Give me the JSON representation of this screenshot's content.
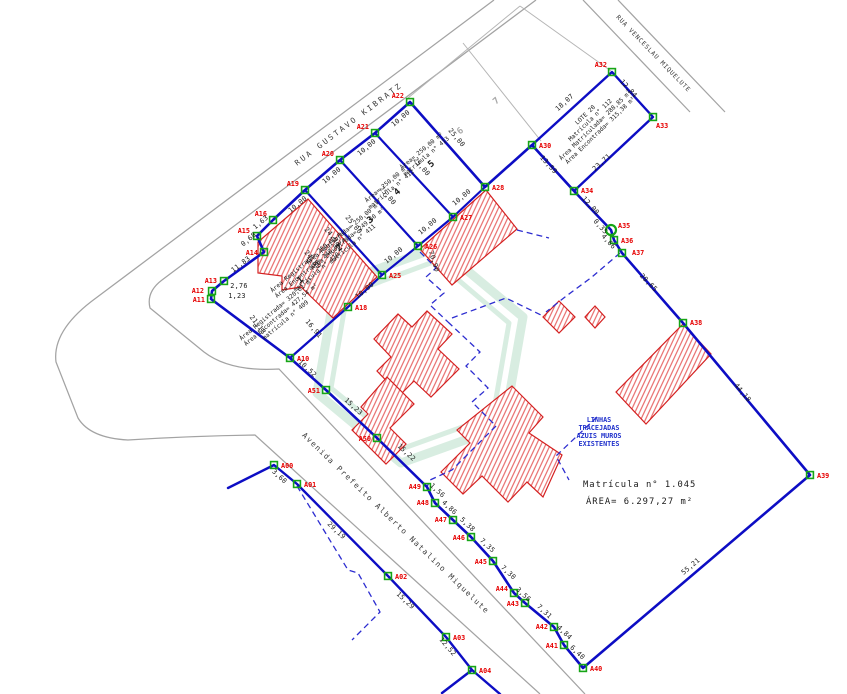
{
  "colors": {
    "boundary_blue": "#0d0dc4",
    "wall_dashed_blue": "#2d2dd0",
    "marker_green": "#16a516",
    "vertex_label_red": "#e60000",
    "building_outline_red": "#d42020",
    "hatch_red": "#e66060",
    "street_gray": "#a3a3a3",
    "cad_black": "#1a1a1a",
    "note_blue": "#2233cc",
    "watermark_green": "#cfe9da"
  },
  "streets": {
    "names": [
      {
        "name": "RUA GUSTAVO KIBRATZ",
        "x": 350,
        "y": 126,
        "rot": -37,
        "size": 7.6,
        "spacing": 2.4
      },
      {
        "name": "RUA VENCESLAU MIQUELUTE",
        "x": 652,
        "y": 55,
        "rot": 46,
        "size": 6.2,
        "spacing": 0.8
      },
      {
        "name": "Avenida Prefeito Alberto Natalino Miquelute",
        "x": 394,
        "y": 525,
        "rot": 44,
        "size": 7.6,
        "spacing": 1.4
      }
    ],
    "paths": [
      "M494,0 L96,298 Q52,330 56,362 L78,418 Q90,438 128,440 Q190,436 255,435 L540,694",
      "M536,0 L162,280 Q146,292 150,308 L204,352 Q230,372 279,369 L585,694",
      "M583,0 L690,112",
      "M618,0 L725,112"
    ]
  },
  "gray_lots": {
    "lines": [
      "M408,98 L520,6",
      "M520,6 L611,71",
      "M463,43 L541,141"
    ],
    "numbers": [
      {
        "t": "6",
        "x": 462,
        "y": 133
      },
      {
        "t": "7",
        "x": 498,
        "y": 103
      }
    ]
  },
  "watermark": {
    "outer": "523,317 439,247 336,284 317,393 401,463 504,426",
    "inner": "509,323 436,261 347,294 331,388 404,448 493,416"
  },
  "buildings": [
    {
      "pts": "308,199 377,277 333,318 301,287 282,290 282,276 258,273 258,242"
    },
    {
      "pts": "486,190 517,229 452,285 420,249"
    },
    {
      "pts": "427,311 452,334 438,349 459,369 431,397 414,381 400,395 377,371 391,357 374,339 398,314 412,327"
    },
    {
      "pts": "387,377 414,404 390,428 406,444 386,464 352,430 368,414 361,407"
    },
    {
      "pts": "512,386 543,417 529,433 562,455 543,497 527,482 508,502 482,476 463,494 441,472 470,443 457,430"
    },
    {
      "pts": "683,324 711,354 646,424 616,392"
    },
    {
      "pts": "559,301 575,317 559,333 543,317"
    },
    {
      "pts": "595,306 605,317 595,328 585,317"
    }
  ],
  "dashed_walls": [
    "297,486 348,570 358,573 380,612 352,640",
    "420,252 436,268 426,277 444,293 430,305 448,322",
    "448,322 480,352 466,366 488,388 472,402 496,426 452,470 430,480 427,487",
    "452,318 506,298 541,315",
    "620,253 592,277 565,297 546,312",
    "597,417 556,456 569,480",
    "517,230 549,238"
  ],
  "boundaries": [
    {
      "w": 2.6,
      "pts": "290,358 211,299 212,291 224,281 264,252 257,236 273,220 305,190 340,160 375,133 410,102 485,187 532,145 574,191 611,230 614,240 622,253 683,323 810,475 583,668 564,645 554,627 525,603 514,593 493,561 471,537 453,520 435,503 427,487 377,438 326,390 290,358"
    },
    {
      "w": 2.2,
      "pts": "382,275 418,246 453,217 485,187"
    },
    {
      "w": 2.2,
      "pts": "305,190 382,275"
    },
    {
      "w": 2.2,
      "pts": "340,160 418,246"
    },
    {
      "w": 2.2,
      "pts": "375,133 453,217"
    },
    {
      "w": 2.2,
      "pts": "382,275 348,307 290,358"
    },
    {
      "w": 2.4,
      "pts": "532,145 612,72 653,117 574,191 532,145"
    },
    {
      "w": 2.4,
      "pts": "228,488 274,465 297,484 388,576 446,637 472,670 500,694"
    },
    {
      "w": 2.4,
      "pts": "472,670 442,693"
    }
  ],
  "vertices": [
    {
      "id": "A00",
      "x": 274,
      "y": 465,
      "lx": 281,
      "ly": 468,
      "a": "start",
      "m": "sq"
    },
    {
      "id": "A01",
      "x": 297,
      "y": 484,
      "lx": 304,
      "ly": 487,
      "a": "start",
      "m": "sq"
    },
    {
      "id": "A02",
      "x": 388,
      "y": 576,
      "lx": 395,
      "ly": 579,
      "a": "start",
      "m": "sq"
    },
    {
      "id": "A03",
      "x": 446,
      "y": 637,
      "lx": 453,
      "ly": 640,
      "a": "start",
      "m": "sq"
    },
    {
      "id": "A04",
      "x": 472,
      "y": 670,
      "lx": 479,
      "ly": 673,
      "a": "start",
      "m": "sq"
    },
    {
      "id": "A10",
      "x": 290,
      "y": 358,
      "lx": 297,
      "ly": 361,
      "a": "start",
      "m": "sq"
    },
    {
      "id": "A11",
      "x": 211,
      "y": 299,
      "lx": 205,
      "ly": 302,
      "a": "end",
      "m": "sq"
    },
    {
      "id": "A12",
      "x": 212,
      "y": 291,
      "lx": 204,
      "ly": 293,
      "a": "end",
      "m": "sq"
    },
    {
      "id": "A13",
      "x": 224,
      "y": 281,
      "lx": 217,
      "ly": 283,
      "a": "end",
      "m": "sq"
    },
    {
      "id": "A14",
      "x": 264,
      "y": 252,
      "lx": 258,
      "ly": 255,
      "a": "end",
      "m": "sq"
    },
    {
      "id": "A15",
      "x": 257,
      "y": 236,
      "lx": 250,
      "ly": 233,
      "a": "end",
      "m": "sq"
    },
    {
      "id": "A16",
      "x": 273,
      "y": 220,
      "lx": 267,
      "ly": 216,
      "a": "end",
      "m": "sq"
    },
    {
      "id": "A18",
      "x": 348,
      "y": 307,
      "lx": 355,
      "ly": 310,
      "a": "start",
      "m": "sq"
    },
    {
      "id": "A19",
      "x": 305,
      "y": 190,
      "lx": 299,
      "ly": 186,
      "a": "end",
      "m": "sq"
    },
    {
      "id": "A20",
      "x": 340,
      "y": 160,
      "lx": 334,
      "ly": 156,
      "a": "end",
      "m": "sq"
    },
    {
      "id": "A21",
      "x": 375,
      "y": 133,
      "lx": 369,
      "ly": 129,
      "a": "end",
      "m": "sq"
    },
    {
      "id": "A22",
      "x": 410,
      "y": 102,
      "lx": 404,
      "ly": 98,
      "a": "end",
      "m": "sq"
    },
    {
      "id": "A25",
      "x": 382,
      "y": 275,
      "lx": 389,
      "ly": 278,
      "a": "start",
      "m": "sq"
    },
    {
      "id": "A26",
      "x": 418,
      "y": 246,
      "lx": 425,
      "ly": 249,
      "a": "start",
      "m": "sq"
    },
    {
      "id": "A27",
      "x": 453,
      "y": 217,
      "lx": 460,
      "ly": 220,
      "a": "start",
      "m": "sq"
    },
    {
      "id": "A28",
      "x": 485,
      "y": 187,
      "lx": 492,
      "ly": 190,
      "a": "start",
      "m": "sq"
    },
    {
      "id": "A30",
      "x": 532,
      "y": 145,
      "lx": 539,
      "ly": 148,
      "a": "start",
      "m": "sq"
    },
    {
      "id": "A32",
      "x": 612,
      "y": 72,
      "lx": 607,
      "ly": 67,
      "a": "end",
      "m": "sq"
    },
    {
      "id": "A33",
      "x": 653,
      "y": 117,
      "lx": 656,
      "ly": 128,
      "a": "start",
      "m": "sq"
    },
    {
      "id": "A34",
      "x": 574,
      "y": 191,
      "lx": 581,
      "ly": 193,
      "a": "start",
      "m": "sq"
    },
    {
      "id": "A35",
      "x": 611,
      "y": 230,
      "lx": 618,
      "ly": 228,
      "a": "start",
      "m": "ci"
    },
    {
      "id": "A36",
      "x": 614,
      "y": 240,
      "lx": 621,
      "ly": 243,
      "a": "start",
      "m": "sq"
    },
    {
      "id": "A37",
      "x": 622,
      "y": 253,
      "lx": 632,
      "ly": 255,
      "a": "start",
      "m": "sq"
    },
    {
      "id": "A38",
      "x": 683,
      "y": 323,
      "lx": 690,
      "ly": 325,
      "a": "start",
      "m": "sq"
    },
    {
      "id": "A39",
      "x": 810,
      "y": 475,
      "lx": 817,
      "ly": 478,
      "a": "start",
      "m": "sq"
    },
    {
      "id": "A40",
      "x": 583,
      "y": 668,
      "lx": 590,
      "ly": 671,
      "a": "start",
      "m": "sq"
    },
    {
      "id": "A41",
      "x": 564,
      "y": 645,
      "lx": 558,
      "ly": 648,
      "a": "end",
      "m": "sq"
    },
    {
      "id": "A42",
      "x": 554,
      "y": 627,
      "lx": 548,
      "ly": 629,
      "a": "end",
      "m": "sq"
    },
    {
      "id": "A43",
      "x": 525,
      "y": 603,
      "lx": 519,
      "ly": 606,
      "a": "end",
      "m": "sq"
    },
    {
      "id": "A44",
      "x": 514,
      "y": 593,
      "lx": 508,
      "ly": 591,
      "a": "end",
      "m": "sq"
    },
    {
      "id": "A45",
      "x": 493,
      "y": 561,
      "lx": 487,
      "ly": 564,
      "a": "end",
      "m": "sq"
    },
    {
      "id": "A46",
      "x": 471,
      "y": 537,
      "lx": 465,
      "ly": 540,
      "a": "end",
      "m": "sq"
    },
    {
      "id": "A47",
      "x": 453,
      "y": 520,
      "lx": 447,
      "ly": 522,
      "a": "end",
      "m": "sq"
    },
    {
      "id": "A48",
      "x": 435,
      "y": 503,
      "lx": 429,
      "ly": 505,
      "a": "end",
      "m": "sq"
    },
    {
      "id": "A49",
      "x": 427,
      "y": 487,
      "lx": 421,
      "ly": 489,
      "a": "end",
      "m": "sq"
    },
    {
      "id": "A50",
      "x": 377,
      "y": 438,
      "lx": 371,
      "ly": 441,
      "a": "end",
      "m": "sq"
    },
    {
      "id": "A51",
      "x": 326,
      "y": 390,
      "lx": 320,
      "ly": 393,
      "a": "end",
      "m": "sq"
    }
  ],
  "measurements": [
    {
      "t": "10,00",
      "x": 299,
      "y": 206,
      "r": -40
    },
    {
      "t": "10,00",
      "x": 333,
      "y": 177,
      "r": -40
    },
    {
      "t": "10,00",
      "x": 368,
      "y": 149,
      "r": -40
    },
    {
      "t": "10,00",
      "x": 402,
      "y": 120,
      "r": -40
    },
    {
      "t": "10,00",
      "x": 395,
      "y": 257,
      "r": -40
    },
    {
      "t": "10,00",
      "x": 429,
      "y": 228,
      "r": -40
    },
    {
      "t": "10,00",
      "x": 463,
      "y": 199,
      "r": -40
    },
    {
      "t": "10,00",
      "x": 366,
      "y": 292,
      "r": -40
    },
    {
      "t": "25,00",
      "x": 352,
      "y": 226,
      "r": 50
    },
    {
      "t": "25,00",
      "x": 386,
      "y": 197,
      "r": 50
    },
    {
      "t": "25,00",
      "x": 420,
      "y": 168,
      "r": 50
    },
    {
      "t": "25,00",
      "x": 455,
      "y": 139,
      "r": 50
    },
    {
      "t": "70,90",
      "x": 432,
      "y": 262,
      "r": 72
    },
    {
      "t": "24,93",
      "x": 331,
      "y": 238,
      "r": 50
    },
    {
      "t": "24,89",
      "x": 311,
      "y": 261,
      "r": 50
    },
    {
      "t": "16,91",
      "x": 312,
      "y": 330,
      "r": 50
    },
    {
      "t": "21,18",
      "x": 256,
      "y": 326,
      "r": 52
    },
    {
      "t": "11,83",
      "x": 242,
      "y": 266,
      "r": -37
    },
    {
      "t": "2,76",
      "x": 239,
      "y": 288,
      "r": 0
    },
    {
      "t": "1,23",
      "x": 237,
      "y": 298,
      "r": 0
    },
    {
      "t": "0,68",
      "x": 250,
      "y": 241,
      "r": -40
    },
    {
      "t": "1,63",
      "x": 262,
      "y": 224,
      "r": -40
    },
    {
      "t": "10,52",
      "x": 306,
      "y": 370,
      "r": 43
    },
    {
      "t": "15,23",
      "x": 352,
      "y": 408,
      "r": 43
    },
    {
      "t": "15,22",
      "x": 405,
      "y": 454,
      "r": 43
    },
    {
      "t": "3,60",
      "x": 278,
      "y": 478,
      "r": 43
    },
    {
      "t": "29,19",
      "x": 335,
      "y": 532,
      "r": 43
    },
    {
      "t": "15,29",
      "x": 404,
      "y": 602,
      "r": 43
    },
    {
      "t": "12,52",
      "x": 446,
      "y": 648,
      "r": 50
    },
    {
      "t": "1,56",
      "x": 436,
      "y": 492,
      "r": 43
    },
    {
      "t": "4,86",
      "x": 448,
      "y": 509,
      "r": 43
    },
    {
      "t": "5,38",
      "x": 466,
      "y": 526,
      "r": 43
    },
    {
      "t": "7,35",
      "x": 486,
      "y": 547,
      "r": 43
    },
    {
      "t": "7,30",
      "x": 507,
      "y": 574,
      "r": 43
    },
    {
      "t": "3,56",
      "x": 522,
      "y": 596,
      "r": 43
    },
    {
      "t": "7,31",
      "x": 543,
      "y": 613,
      "r": 43
    },
    {
      "t": "4,84",
      "x": 563,
      "y": 634,
      "r": 43
    },
    {
      "t": "6,40",
      "x": 576,
      "y": 654,
      "r": 43
    },
    {
      "t": "12,00",
      "x": 589,
      "y": 207,
      "r": 48
    },
    {
      "t": "0,35",
      "x": 599,
      "y": 228,
      "r": 48
    },
    {
      "t": "4,66",
      "x": 607,
      "y": 243,
      "r": 48
    },
    {
      "t": "20,65",
      "x": 647,
      "y": 284,
      "r": 46
    },
    {
      "t": "44,18",
      "x": 741,
      "y": 394,
      "r": 50
    },
    {
      "t": "55,21",
      "x": 692,
      "y": 568,
      "r": -40
    },
    {
      "t": "13,59",
      "x": 547,
      "y": 166,
      "r": 48
    },
    {
      "t": "18,07",
      "x": 566,
      "y": 104,
      "r": -42
    },
    {
      "t": "12,84",
      "x": 627,
      "y": 90,
      "r": 48
    },
    {
      "t": "23,71",
      "x": 603,
      "y": 164,
      "r": -42
    }
  ],
  "lot_texts": [
    {
      "lines": [
        "Área Registrada= 320,61 m²",
        "Área Encontrada= 427,54 m²",
        "matrícula n° 409"
      ],
      "x": 282,
      "y": 316,
      "rot": -40
    },
    {
      "lines": [
        "Área Registrada= 250,00 m²",
        "Área Encontrada= 248,08 m²",
        "matrícula n° 410"
      ],
      "x": 313,
      "y": 268,
      "rot": -40
    },
    {
      "lines": [
        "Área Registrada= 250,00 m²",
        "Área Encontrada= 249,60 m²",
        "matrícula n° 411"
      ],
      "x": 349,
      "y": 240,
      "rot": -40
    },
    {
      "lines": [
        "Área= 250,00 m²",
        "matrícula n° 412"
      ],
      "x": 390,
      "y": 188,
      "rot": -40
    },
    {
      "lines": [
        "Área= 250,00 m²",
        "matrícula n° 413"
      ],
      "x": 425,
      "y": 155,
      "rot": -40
    }
  ],
  "lot_numbers": [
    {
      "t": "1",
      "x": 302,
      "y": 282
    },
    {
      "t": "2",
      "x": 341,
      "y": 250
    },
    {
      "t": "3",
      "x": 372,
      "y": 222
    },
    {
      "t": "4",
      "x": 399,
      "y": 194
    },
    {
      "t": "5",
      "x": 433,
      "y": 166
    }
  ],
  "notes": {
    "matricula": {
      "lines": [
        "Matrícula n° 1.045",
        "ÁREA= 6.297,27 m²"
      ],
      "x": 583,
      "y": 487,
      "lh": 17
    },
    "linhas": {
      "lines": [
        "LINHAS",
        "TRACEJADAS",
        "AZUIS MUROS",
        "EXISTENTES"
      ],
      "x": 599,
      "y": 422,
      "lh": 8
    },
    "lote20": {
      "lines": [
        "LOTE 20",
        "Matrícula n° 112",
        "Área Matriculada= 288,85 m²",
        "Área Encontrada= 315,38 m²"
      ],
      "x": 594,
      "y": 124,
      "rot": -44,
      "lh": 7.2
    }
  }
}
